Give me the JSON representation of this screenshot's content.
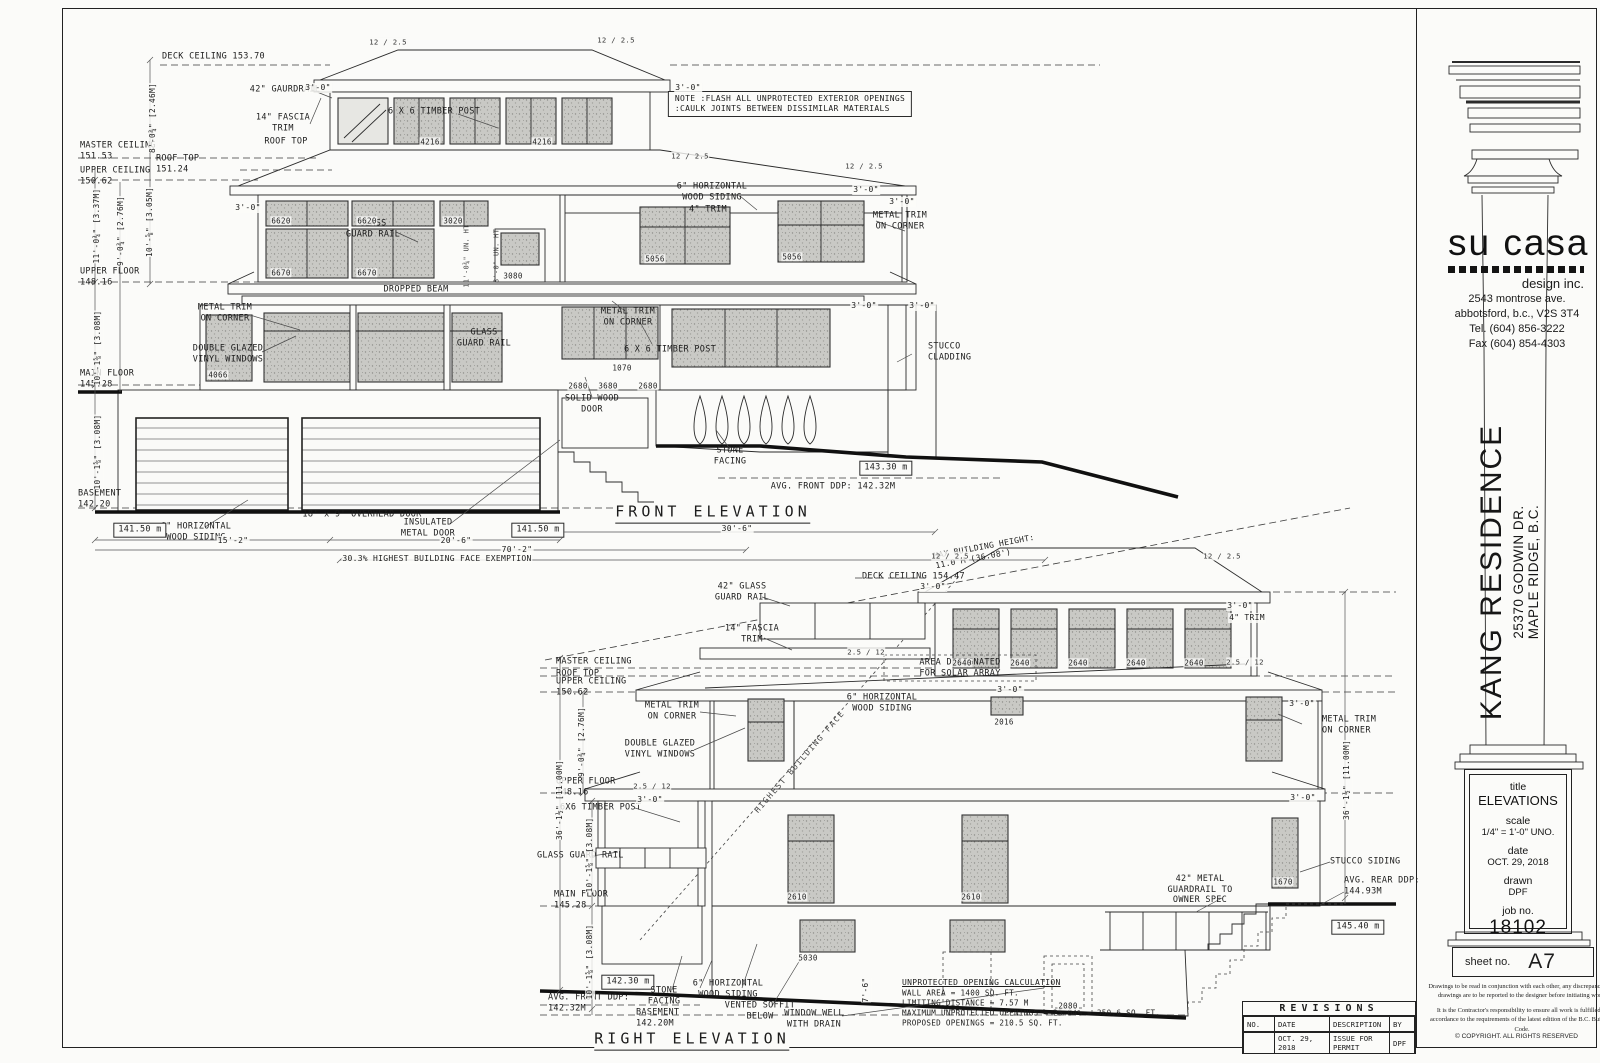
{
  "titleblock": {
    "logo": "su casa",
    "tagline": "design inc.",
    "address": [
      "2543 montrose ave.",
      "abbotsford, b.c., V2S 3T4",
      "Tel. (604) 856-3222",
      "Fax (604) 854-4303"
    ],
    "project_name": "KANG RESIDENCE",
    "project_addr1": "25370 GODWIN DR.",
    "project_addr2": "MAPLE RIDGE, B.C.",
    "fields": [
      {
        "k": "title",
        "v": "ELEVATIONS"
      },
      {
        "k": "scale",
        "v": "1/4\" = 1'-0\" UNO."
      },
      {
        "k": "date",
        "v": "OCT. 29, 2018"
      },
      {
        "k": "drawn",
        "v": "DPF"
      },
      {
        "k": "job no.",
        "v": "18102"
      }
    ],
    "sheet_label": "sheet no.",
    "sheet_no": "A7",
    "note1": "Drawings to be read in conjunction with each other, any discrepancies on drawings are to be reported to the designer before initiating work.",
    "note2": "It is the Contractor's responsibility to ensure all work is fulfilled in accordance to the requirements of the latest edition of the B.C. Building Code.",
    "copyright": "© COPYRIGHT.   ALL RIGHTS RESERVED"
  },
  "revisions": {
    "title": "REVISIONS",
    "headers": [
      "NO.",
      "DATE",
      "DESCRIPTION",
      "BY"
    ],
    "row": {
      "no": "",
      "date": "OCT. 29, 2018",
      "desc": "ISSUE FOR PERMIT",
      "by": "DPF"
    }
  },
  "front": {
    "labels": [
      {
        "t": "DECK CEILING 153.70",
        "x": 162,
        "y": 57,
        "c": "l"
      },
      {
        "t": "MASTER CEILING\n151.53",
        "x": 80,
        "y": 151,
        "c": "l"
      },
      {
        "t": "ROOF TOP\n151.24",
        "x": 156,
        "y": 164,
        "c": "l"
      },
      {
        "t": "UPPER CEILING\n150.62",
        "x": 80,
        "y": 176,
        "c": "l"
      },
      {
        "t": "UPPER FLOOR\n148.16",
        "x": 80,
        "y": 277,
        "c": "l"
      },
      {
        "t": "MAIN FLOOR\n145.28",
        "x": 80,
        "y": 379,
        "c": "l"
      },
      {
        "t": "BASEMENT\n142.20",
        "x": 78,
        "y": 499,
        "c": "l"
      },
      {
        "t": "42\" GAURDRAIL",
        "x": 285,
        "y": 90
      },
      {
        "t": "14\" FASCIA\nTRIM",
        "x": 283,
        "y": 123
      },
      {
        "t": "ROOF TOP",
        "x": 286,
        "y": 142
      },
      {
        "t": "NOTE :FLASH ALL UNPROTECTED EXTERIOR OPENINGS\n:CAULK JOINTS BETWEEN DISSIMILAR MATERIALS",
        "x": 790,
        "y": 104,
        "c": "note"
      },
      {
        "t": "6 X 6 TIMBER POST",
        "x": 434,
        "y": 112
      },
      {
        "t": "6\" HORIZONTAL\nWOOD SIDING",
        "x": 712,
        "y": 192
      },
      {
        "t": "4\" TRIM",
        "x": 708,
        "y": 210
      },
      {
        "t": "METAL TRIM\nON CORNER",
        "x": 900,
        "y": 221
      },
      {
        "t": "GLASS\nGUARD RAIL",
        "x": 373,
        "y": 229
      },
      {
        "t": "DROPPED BEAM",
        "x": 416,
        "y": 290
      },
      {
        "t": "METAL TRIM\nON CORNER",
        "x": 225,
        "y": 313
      },
      {
        "t": "DOUBLE GLAZED\nVINYL WINDOWS",
        "x": 228,
        "y": 354
      },
      {
        "t": "6 X 6 TIMBER POST",
        "x": 670,
        "y": 350
      },
      {
        "t": "GLASS\nGUARD RAIL",
        "x": 484,
        "y": 338
      },
      {
        "t": "METAL TRIM\nON CORNER",
        "x": 628,
        "y": 317
      },
      {
        "t": "STUCCO\nCLADDING",
        "x": 928,
        "y": 352,
        "c": "l"
      },
      {
        "t": "SOLID WOOD\nDOOR",
        "x": 592,
        "y": 404
      },
      {
        "t": "STONE\nFACING",
        "x": 730,
        "y": 456
      },
      {
        "t": "18' x 9' OVERHEAD DOOR",
        "x": 362,
        "y": 515
      },
      {
        "t": "INSULATED\nMETAL DOOR",
        "x": 428,
        "y": 528
      },
      {
        "t": "6\" HORIZONTAL\nWOOD SIDING",
        "x": 196,
        "y": 532
      },
      {
        "t": "141.50 m",
        "x": 140,
        "y": 530,
        "c": "box"
      },
      {
        "t": "141.50 m",
        "x": 538,
        "y": 530,
        "c": "box"
      },
      {
        "t": "15'-2\"",
        "x": 233,
        "y": 541,
        "c": "dim"
      },
      {
        "t": "20'-6\"",
        "x": 456,
        "y": 541,
        "c": "dim"
      },
      {
        "t": "70'-2\"",
        "x": 517,
        "y": 550,
        "c": "dim"
      },
      {
        "t": "30'-6\"",
        "x": 737,
        "y": 529,
        "c": "dim"
      },
      {
        "t": "30.3% HIGHEST BUILDING FACE EXEMPTION",
        "x": 437,
        "y": 559,
        "c": "dim"
      },
      {
        "t": "AVG. FRONT DDP: 142.32M",
        "x": 833,
        "y": 487
      },
      {
        "t": "143.30 m",
        "x": 886,
        "y": 468,
        "c": "box"
      },
      {
        "t": "FRONT ELEVATION",
        "x": 713,
        "y": 513,
        "c": "ttl"
      },
      {
        "t": "4216",
        "x": 430,
        "y": 142,
        "c": "code"
      },
      {
        "t": "4216",
        "x": 542,
        "y": 142,
        "c": "code"
      },
      {
        "t": "6620",
        "x": 281,
        "y": 221,
        "c": "code"
      },
      {
        "t": "6620",
        "x": 367,
        "y": 221,
        "c": "code"
      },
      {
        "t": "3020",
        "x": 453,
        "y": 221,
        "c": "code"
      },
      {
        "t": "6670",
        "x": 281,
        "y": 273,
        "c": "code"
      },
      {
        "t": "6670",
        "x": 367,
        "y": 273,
        "c": "code"
      },
      {
        "t": "3080",
        "x": 513,
        "y": 276,
        "c": "code"
      },
      {
        "t": "5056",
        "x": 655,
        "y": 259,
        "c": "code"
      },
      {
        "t": "5056",
        "x": 792,
        "y": 257,
        "c": "code"
      },
      {
        "t": "4066",
        "x": 218,
        "y": 375,
        "c": "code"
      },
      {
        "t": "1070",
        "x": 622,
        "y": 368,
        "c": "code"
      },
      {
        "t": "2680",
        "x": 578,
        "y": 386,
        "c": "code"
      },
      {
        "t": "3680",
        "x": 608,
        "y": 386,
        "c": "code"
      },
      {
        "t": "2680",
        "x": 648,
        "y": 386,
        "c": "code"
      },
      {
        "t": "8'-0¾\" [2.46M]",
        "x": 153,
        "y": 118,
        "c": "rot"
      },
      {
        "t": "11'-0¾\" [3.37M]",
        "x": 97,
        "y": 226,
        "c": "rot"
      },
      {
        "t": "9'-0¾\" [2.76M]",
        "x": 121,
        "y": 231,
        "c": "rot"
      },
      {
        "t": "10'-⅝\" [3.05M]",
        "x": 150,
        "y": 222,
        "c": "rot"
      },
      {
        "t": "10'-1⅝\" [3.08M]",
        "x": 98,
        "y": 348,
        "c": "rot"
      },
      {
        "t": "10'-1⅝\" [3.08M]",
        "x": 98,
        "y": 452,
        "c": "rot"
      },
      {
        "t": "11'-0¾\" UN. HT",
        "x": 467,
        "y": 256,
        "c": "rots"
      },
      {
        "t": "8'-0\" UN. HT",
        "x": 497,
        "y": 256,
        "c": "rots"
      },
      {
        "t": "12 / 2.5",
        "x": 388,
        "y": 42,
        "c": "slope"
      },
      {
        "t": "12 / 2.5",
        "x": 616,
        "y": 40,
        "c": "slope"
      },
      {
        "t": "12 / 2.5",
        "x": 690,
        "y": 156,
        "c": "slope"
      },
      {
        "t": "12 / 2.5",
        "x": 864,
        "y": 166,
        "c": "slope"
      },
      {
        "t": "3'-0\"",
        "x": 318,
        "y": 88,
        "c": "dim"
      },
      {
        "t": "3'-0\"",
        "x": 688,
        "y": 88,
        "c": "dim"
      },
      {
        "t": "3'-0\"",
        "x": 866,
        "y": 190,
        "c": "dim"
      },
      {
        "t": "3'-0\"",
        "x": 902,
        "y": 202,
        "c": "dim"
      },
      {
        "t": "3'-0\"",
        "x": 864,
        "y": 306,
        "c": "dim"
      },
      {
        "t": "3'-0\"",
        "x": 922,
        "y": 306,
        "c": "dim"
      },
      {
        "t": "3'-0\"",
        "x": 248,
        "y": 208,
        "c": "dim"
      }
    ]
  },
  "right": {
    "labels": [
      {
        "t": "MAX BUILDING HEIGHT:\n11.0 M (36.08')",
        "x": 985,
        "y": 552,
        "c": "maxh"
      },
      {
        "t": "DECK CEILING 154.47",
        "x": 862,
        "y": 577,
        "c": "l"
      },
      {
        "t": "MASTER CEILING",
        "x": 556,
        "y": 662,
        "c": "l"
      },
      {
        "t": "ROOF TOP",
        "x": 556,
        "y": 674,
        "c": "l"
      },
      {
        "t": "UPPER CEILING\n150.62",
        "x": 556,
        "y": 687,
        "c": "l"
      },
      {
        "t": "UPPER FLOOR\n148.16",
        "x": 556,
        "y": 787,
        "c": "l"
      },
      {
        "t": "MAIN FLOOR\n145.28",
        "x": 554,
        "y": 900,
        "c": "l"
      },
      {
        "t": "BASEMENT\n142.20M",
        "x": 636,
        "y": 1018,
        "c": "l"
      },
      {
        "t": "42\" GLASS\nGUARD RAIL",
        "x": 742,
        "y": 592
      },
      {
        "t": "14\" FASCIA\nTRIM",
        "x": 752,
        "y": 634
      },
      {
        "t": "AREA DESIGNATED\nFOR SOLAR ARRAY",
        "x": 960,
        "y": 668
      },
      {
        "t": "6\" HORIZONTAL\nWOOD SIDING",
        "x": 882,
        "y": 703
      },
      {
        "t": "METAL TRIM\nON CORNER",
        "x": 672,
        "y": 711
      },
      {
        "t": "DOUBLE GLAZED\nVINYL WINDOWS",
        "x": 660,
        "y": 749
      },
      {
        "t": "6X6 TIMBER POST",
        "x": 560,
        "y": 808,
        "c": "l"
      },
      {
        "t": "GLASS GUARD RAIL",
        "x": 537,
        "y": 856,
        "c": "l"
      },
      {
        "t": "METAL TRIM\nON CORNER",
        "x": 1322,
        "y": 725,
        "c": "l"
      },
      {
        "t": "4\" TRIM",
        "x": 1247,
        "y": 618,
        "c": "dim"
      },
      {
        "t": "STUCCO SIDING",
        "x": 1330,
        "y": 862,
        "c": "l"
      },
      {
        "t": "42\" METAL\nGUARDRAIL TO\nOWNER SPEC",
        "x": 1200,
        "y": 890
      },
      {
        "t": "AVG. REAR DDP:\n144.93M",
        "x": 1344,
        "y": 886,
        "c": "l"
      },
      {
        "t": "145.40 m",
        "x": 1358,
        "y": 927,
        "c": "box"
      },
      {
        "t": "142.30 m",
        "x": 628,
        "y": 982,
        "c": "box"
      },
      {
        "t": "STONE\nFACING",
        "x": 664,
        "y": 996
      },
      {
        "t": "AVG. FRONT DDP:\n142.32M",
        "x": 548,
        "y": 1003,
        "c": "l"
      },
      {
        "t": "6\" HORIZONTAL\nWOOD SIDING",
        "x": 728,
        "y": 989
      },
      {
        "t": "VENTED SOFFIT\nBELOW",
        "x": 760,
        "y": 1011
      },
      {
        "t": "WINDOW WELL\nWITH DRAIN",
        "x": 814,
        "y": 1019
      },
      {
        "t": "UNPROTECTED OPENING CALCULATION",
        "x": 902,
        "y": 983,
        "c": "lu"
      },
      {
        "t": "WALL AREA = 1400 SQ. FT.\nLIMITING DISTANCE = 7.57 M\nMAXIMUM UNPROTECTED OPENINGS = 25.04% = 350.6 SQ. FT.\nPROPOSED OPENINGS = 210.5 SQ. FT.",
        "x": 902,
        "y": 1008,
        "c": "sm"
      },
      {
        "t": "HIGHEST BUILDING FACE",
        "x": 800,
        "y": 762,
        "c": "hbf"
      },
      {
        "t": "RIGHT ELEVATION",
        "x": 692,
        "y": 1040,
        "c": "ttl"
      },
      {
        "t": "2640",
        "x": 962,
        "y": 663,
        "c": "code"
      },
      {
        "t": "2640",
        "x": 1020,
        "y": 663,
        "c": "code"
      },
      {
        "t": "2640",
        "x": 1078,
        "y": 663,
        "c": "code"
      },
      {
        "t": "2640",
        "x": 1136,
        "y": 663,
        "c": "code"
      },
      {
        "t": "2640",
        "x": 1194,
        "y": 663,
        "c": "code"
      },
      {
        "t": "2016",
        "x": 1004,
        "y": 722,
        "c": "code"
      },
      {
        "t": "2610",
        "x": 797,
        "y": 897,
        "c": "code"
      },
      {
        "t": "2610",
        "x": 971,
        "y": 897,
        "c": "code"
      },
      {
        "t": "5030",
        "x": 808,
        "y": 958,
        "c": "code"
      },
      {
        "t": "2080",
        "x": 1068,
        "y": 1006,
        "c": "code"
      },
      {
        "t": "1670",
        "x": 1283,
        "y": 882,
        "c": "code"
      },
      {
        "t": "36'-1½\" [11.00M]",
        "x": 560,
        "y": 800,
        "c": "rot"
      },
      {
        "t": "36'-1½\" [11.00M]",
        "x": 1347,
        "y": 780,
        "c": "rot"
      },
      {
        "t": "9'-0¾\" [2.76M]",
        "x": 582,
        "y": 742,
        "c": "rot"
      },
      {
        "t": "10'-1⅝\" [3.08M]",
        "x": 590,
        "y": 855,
        "c": "rot"
      },
      {
        "t": "10'-1⅝\" [3.08M]",
        "x": 590,
        "y": 962,
        "c": "rot"
      },
      {
        "t": "7'-6\"",
        "x": 866,
        "y": 990,
        "c": "rot"
      },
      {
        "t": "3'-0\"",
        "x": 933,
        "y": 587,
        "c": "dim"
      },
      {
        "t": "3'-0\"",
        "x": 1240,
        "y": 606,
        "c": "dim"
      },
      {
        "t": "3'-0\"",
        "x": 1302,
        "y": 704,
        "c": "dim"
      },
      {
        "t": "3'-0\"",
        "x": 650,
        "y": 800,
        "c": "dim"
      },
      {
        "t": "3'-0\"",
        "x": 1303,
        "y": 798,
        "c": "dim"
      },
      {
        "t": "3'-0\"",
        "x": 1010,
        "y": 690,
        "c": "dim"
      },
      {
        "t": "12 / 2.5",
        "x": 950,
        "y": 556,
        "c": "slope"
      },
      {
        "t": "12 / 2.5",
        "x": 1222,
        "y": 556,
        "c": "slope"
      },
      {
        "t": "2.5 / 12",
        "x": 866,
        "y": 652,
        "c": "slope"
      },
      {
        "t": "2.5 / 12",
        "x": 1245,
        "y": 662,
        "c": "slope"
      },
      {
        "t": "2.5 / 12",
        "x": 652,
        "y": 786,
        "c": "slope"
      }
    ]
  }
}
